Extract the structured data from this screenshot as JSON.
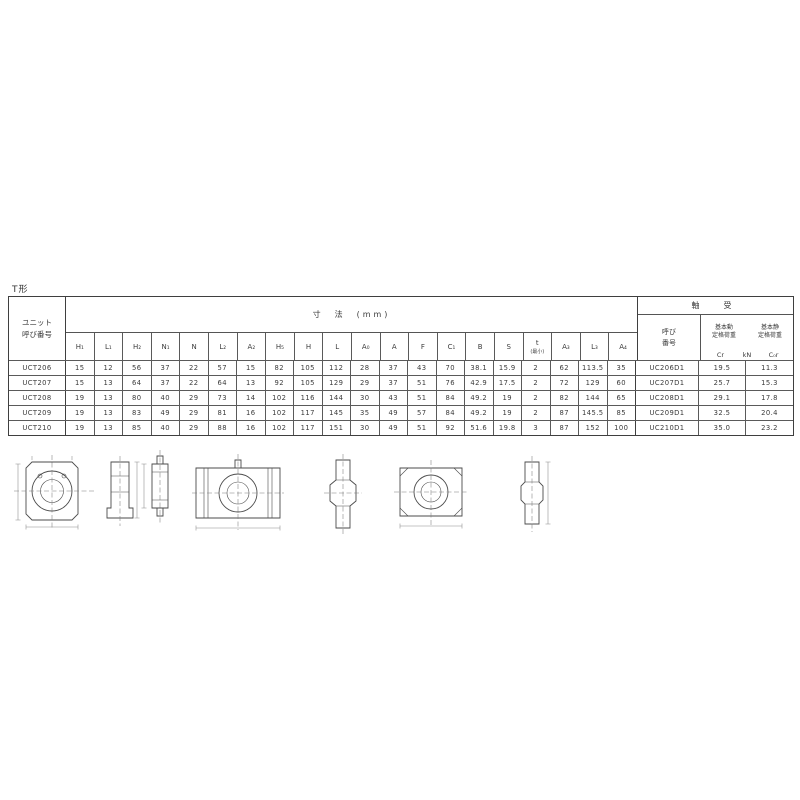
{
  "page": {
    "label": "T形"
  },
  "colors": {
    "ink": "#3b3b3b",
    "line": "#555555",
    "dim_line": "#8a8a8a"
  },
  "table": {
    "unit_header_1": "ユニット",
    "unit_header_2": "呼び番号",
    "dims_title": "寸　法　(mm)",
    "bearing_title": "軸　受",
    "bearing_no_1": "呼び",
    "bearing_no_2": "番号",
    "load": {
      "dynamic_1": "基本動",
      "dynamic_2": "定格荷重",
      "static_1": "基本静",
      "static_2": "定格荷重",
      "cr": "Cr",
      "kn": "kN",
      "c0r": "C₀r"
    },
    "dim_columns": [
      {
        "sym": "H₁"
      },
      {
        "sym": "L₁"
      },
      {
        "sym": "H₂"
      },
      {
        "sym": "N₁"
      },
      {
        "sym": "N"
      },
      {
        "sym": "L₂"
      },
      {
        "sym": "A₂"
      },
      {
        "sym": "H₅"
      },
      {
        "sym": "H"
      },
      {
        "sym": "L"
      },
      {
        "sym": "A₀"
      },
      {
        "sym": "A"
      },
      {
        "sym": "F"
      },
      {
        "sym": "C₁"
      },
      {
        "sym": "B"
      },
      {
        "sym": "S"
      },
      {
        "sym": "t",
        "note": "(最小)"
      },
      {
        "sym": "A₃"
      },
      {
        "sym": "L₃"
      },
      {
        "sym": "A₄"
      }
    ],
    "rows": [
      {
        "unit": "UCT206",
        "dims": [
          "15",
          "12",
          "56",
          "37",
          "22",
          "57",
          "15",
          "82",
          "105",
          "112",
          "28",
          "37",
          "43",
          "70",
          "38.1",
          "15.9",
          "2",
          "62",
          "113.5",
          "35"
        ],
        "bearing": "UC206D1",
        "cr": "19.5",
        "c0r": "11.3"
      },
      {
        "unit": "UCT207",
        "dims": [
          "15",
          "13",
          "64",
          "37",
          "22",
          "64",
          "13",
          "92",
          "105",
          "129",
          "29",
          "37",
          "51",
          "76",
          "42.9",
          "17.5",
          "2",
          "72",
          "129",
          "60"
        ],
        "bearing": "UC207D1",
        "cr": "25.7",
        "c0r": "15.3"
      },
      {
        "unit": "UCT208",
        "dims": [
          "19",
          "13",
          "80",
          "40",
          "29",
          "73",
          "14",
          "102",
          "116",
          "144",
          "30",
          "43",
          "51",
          "84",
          "49.2",
          "19",
          "2",
          "82",
          "144",
          "65"
        ],
        "bearing": "UC208D1",
        "cr": "29.1",
        "c0r": "17.8"
      },
      {
        "unit": "UCT209",
        "dims": [
          "19",
          "13",
          "83",
          "49",
          "29",
          "81",
          "16",
          "102",
          "117",
          "145",
          "35",
          "49",
          "57",
          "84",
          "49.2",
          "19",
          "2",
          "87",
          "145.5",
          "85"
        ],
        "bearing": "UC209D1",
        "cr": "32.5",
        "c0r": "20.4"
      },
      {
        "unit": "UCT210",
        "dims": [
          "19",
          "13",
          "85",
          "40",
          "29",
          "88",
          "16",
          "102",
          "117",
          "151",
          "30",
          "49",
          "51",
          "92",
          "51.6",
          "19.8",
          "3",
          "87",
          "152",
          "100"
        ],
        "bearing": "UC210D1",
        "cr": "35.0",
        "c0r": "23.2"
      }
    ]
  },
  "figures": [
    "uct-front-view",
    "uct-side-view",
    "take-up-frame-side-view",
    "uct-front-view-wide",
    "uct-side-profile",
    "uct-front-view-small",
    "uct-side-profile-2"
  ]
}
